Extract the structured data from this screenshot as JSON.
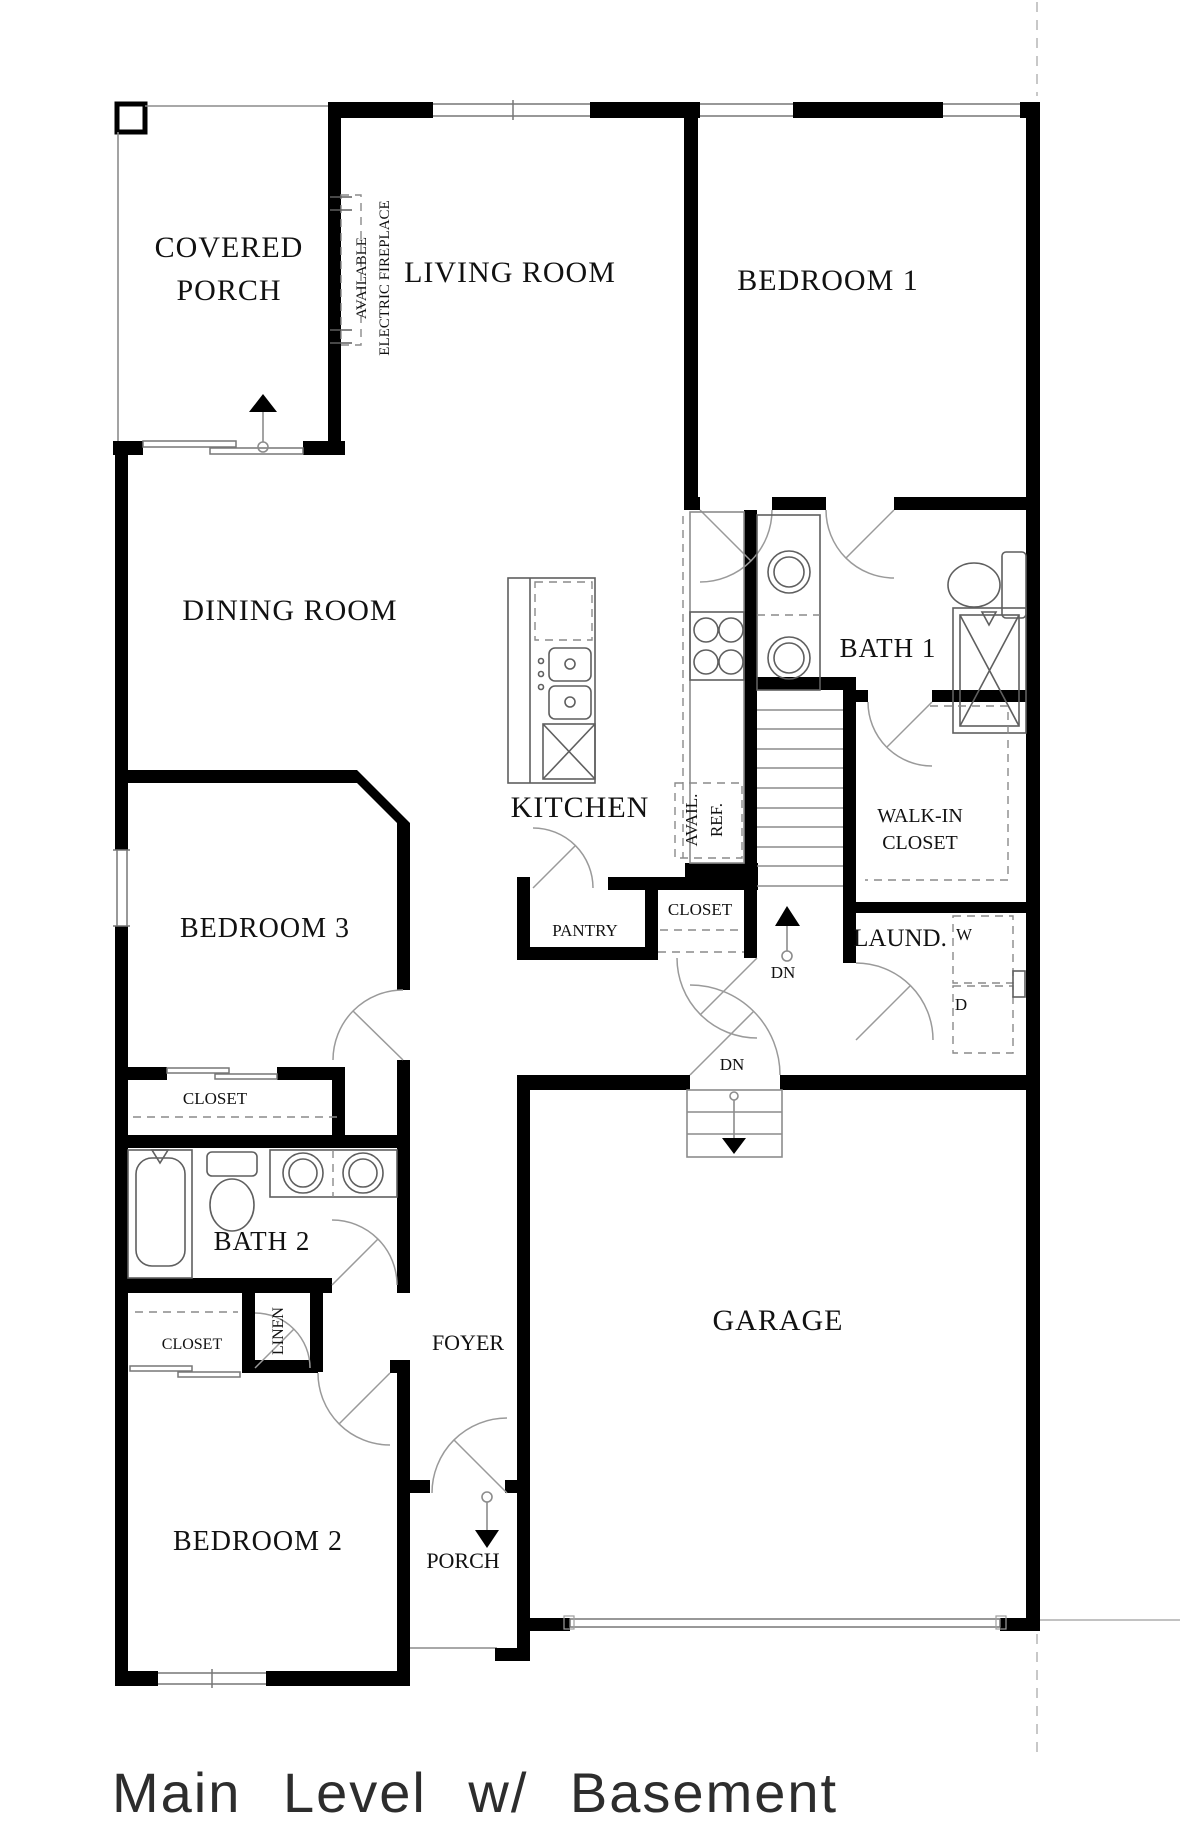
{
  "title": "Main Level w/ Basement",
  "rooms": {
    "covered_porch_line1": "COVERED",
    "covered_porch_line2": "PORCH",
    "living_room": "LIVING ROOM",
    "bedroom1": "BEDROOM 1",
    "dining_room": "DINING ROOM",
    "kitchen": "KITCHEN",
    "bath1": "BATH 1",
    "walk_in_line1": "WALK-IN",
    "walk_in_line2": "CLOSET",
    "laundry": "LAUND.",
    "bedroom3": "BEDROOM 3",
    "bedroom3_closet": "CLOSET",
    "pantry": "PANTRY",
    "hall_closet": "CLOSET",
    "bath2": "BATH 2",
    "bedroom2": "BEDROOM 2",
    "bedroom2_closet": "CLOSET",
    "linen": "LINEN",
    "foyer": "FOYER",
    "porch": "PORCH",
    "garage": "GARAGE"
  },
  "annotations": {
    "fireplace_line1": "AVAILABLE",
    "fireplace_line2": "ELECTRIC FIREPLACE",
    "fridge_line1": "AVAIL.",
    "fridge_line2": "REF.",
    "washer": "W",
    "dryer": "D",
    "stair_down": "DN",
    "garage_down": "DN"
  },
  "colors": {
    "wall": "#000000",
    "thin_line": "#8c8c8c",
    "fixture": "#5f5f5f",
    "text": "#111111"
  }
}
